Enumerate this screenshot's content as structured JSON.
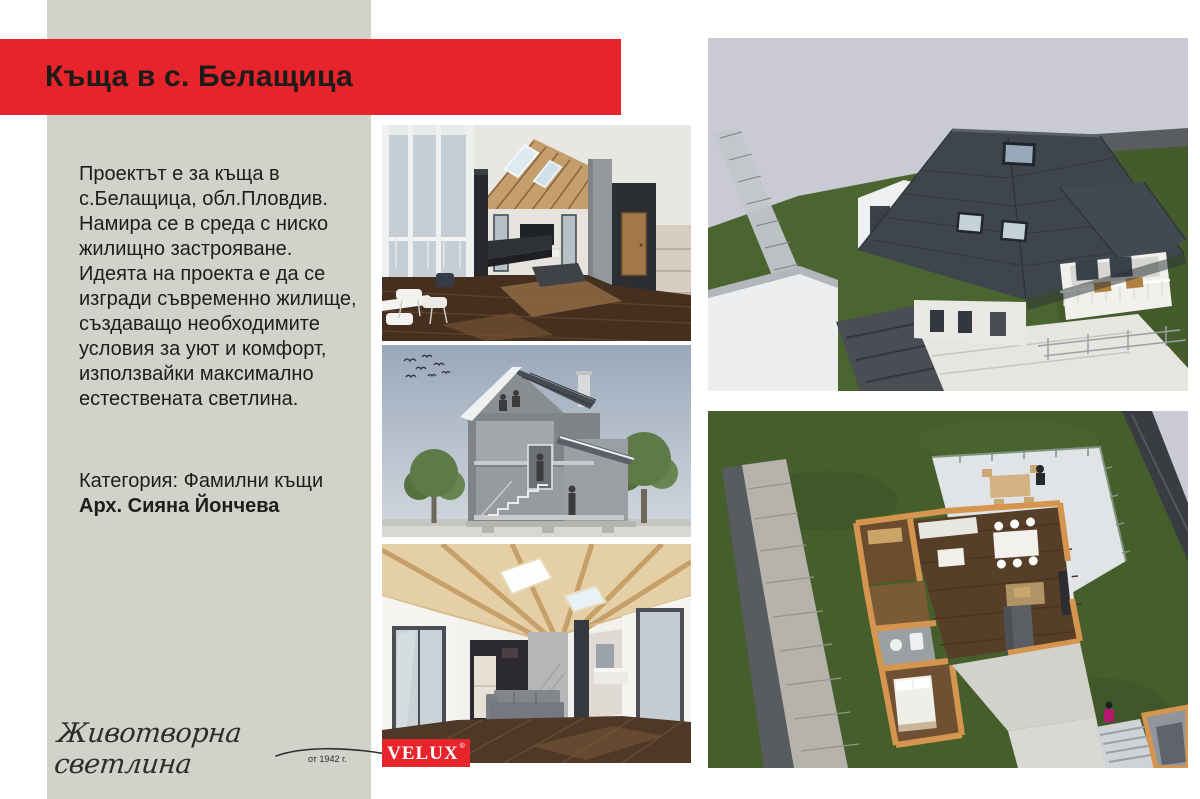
{
  "window": {
    "width": 1200,
    "height": 799
  },
  "theme": {
    "background": "#ffffff",
    "sidebar_bg": "#d2d1ca",
    "accent_red": "#e7242b",
    "ink": "#1c1c1a"
  },
  "header": {
    "title": "Къща в с. Белащица"
  },
  "sidebar": {
    "paragraph": "Проектът е за къща в\nс.Белащица, обл.Пловдив.\nНамира се в среда с ниско\nжилищно застрояване.\nИдеята на проекта е да се\nизгради съвременно жилище,\nсъздаващо необходимите\nусловия за уют и комфорт,\nизползвайки максимално\nестествената светлина.",
    "category": "Категория: Фамилни къщи",
    "architect": "Арх. Сияна Йончева",
    "slogan": "Животворна светлина",
    "since": "от 1942 г."
  },
  "brand": {
    "name": "VELUX",
    "registered": "®"
  },
  "gallery": {
    "interior_top": {
      "label": "interior render — living room with roof windows"
    },
    "section": {
      "label": "house cross-section drawing"
    },
    "interior_bottom": {
      "label": "interior render — open space with wood beam ceiling",
      "wall_sign": "HOME"
    },
    "exterior": {
      "label": "aerial render — house with dark roof and terrace"
    },
    "floor_plan": {
      "label": "3D floor plan top view"
    }
  }
}
